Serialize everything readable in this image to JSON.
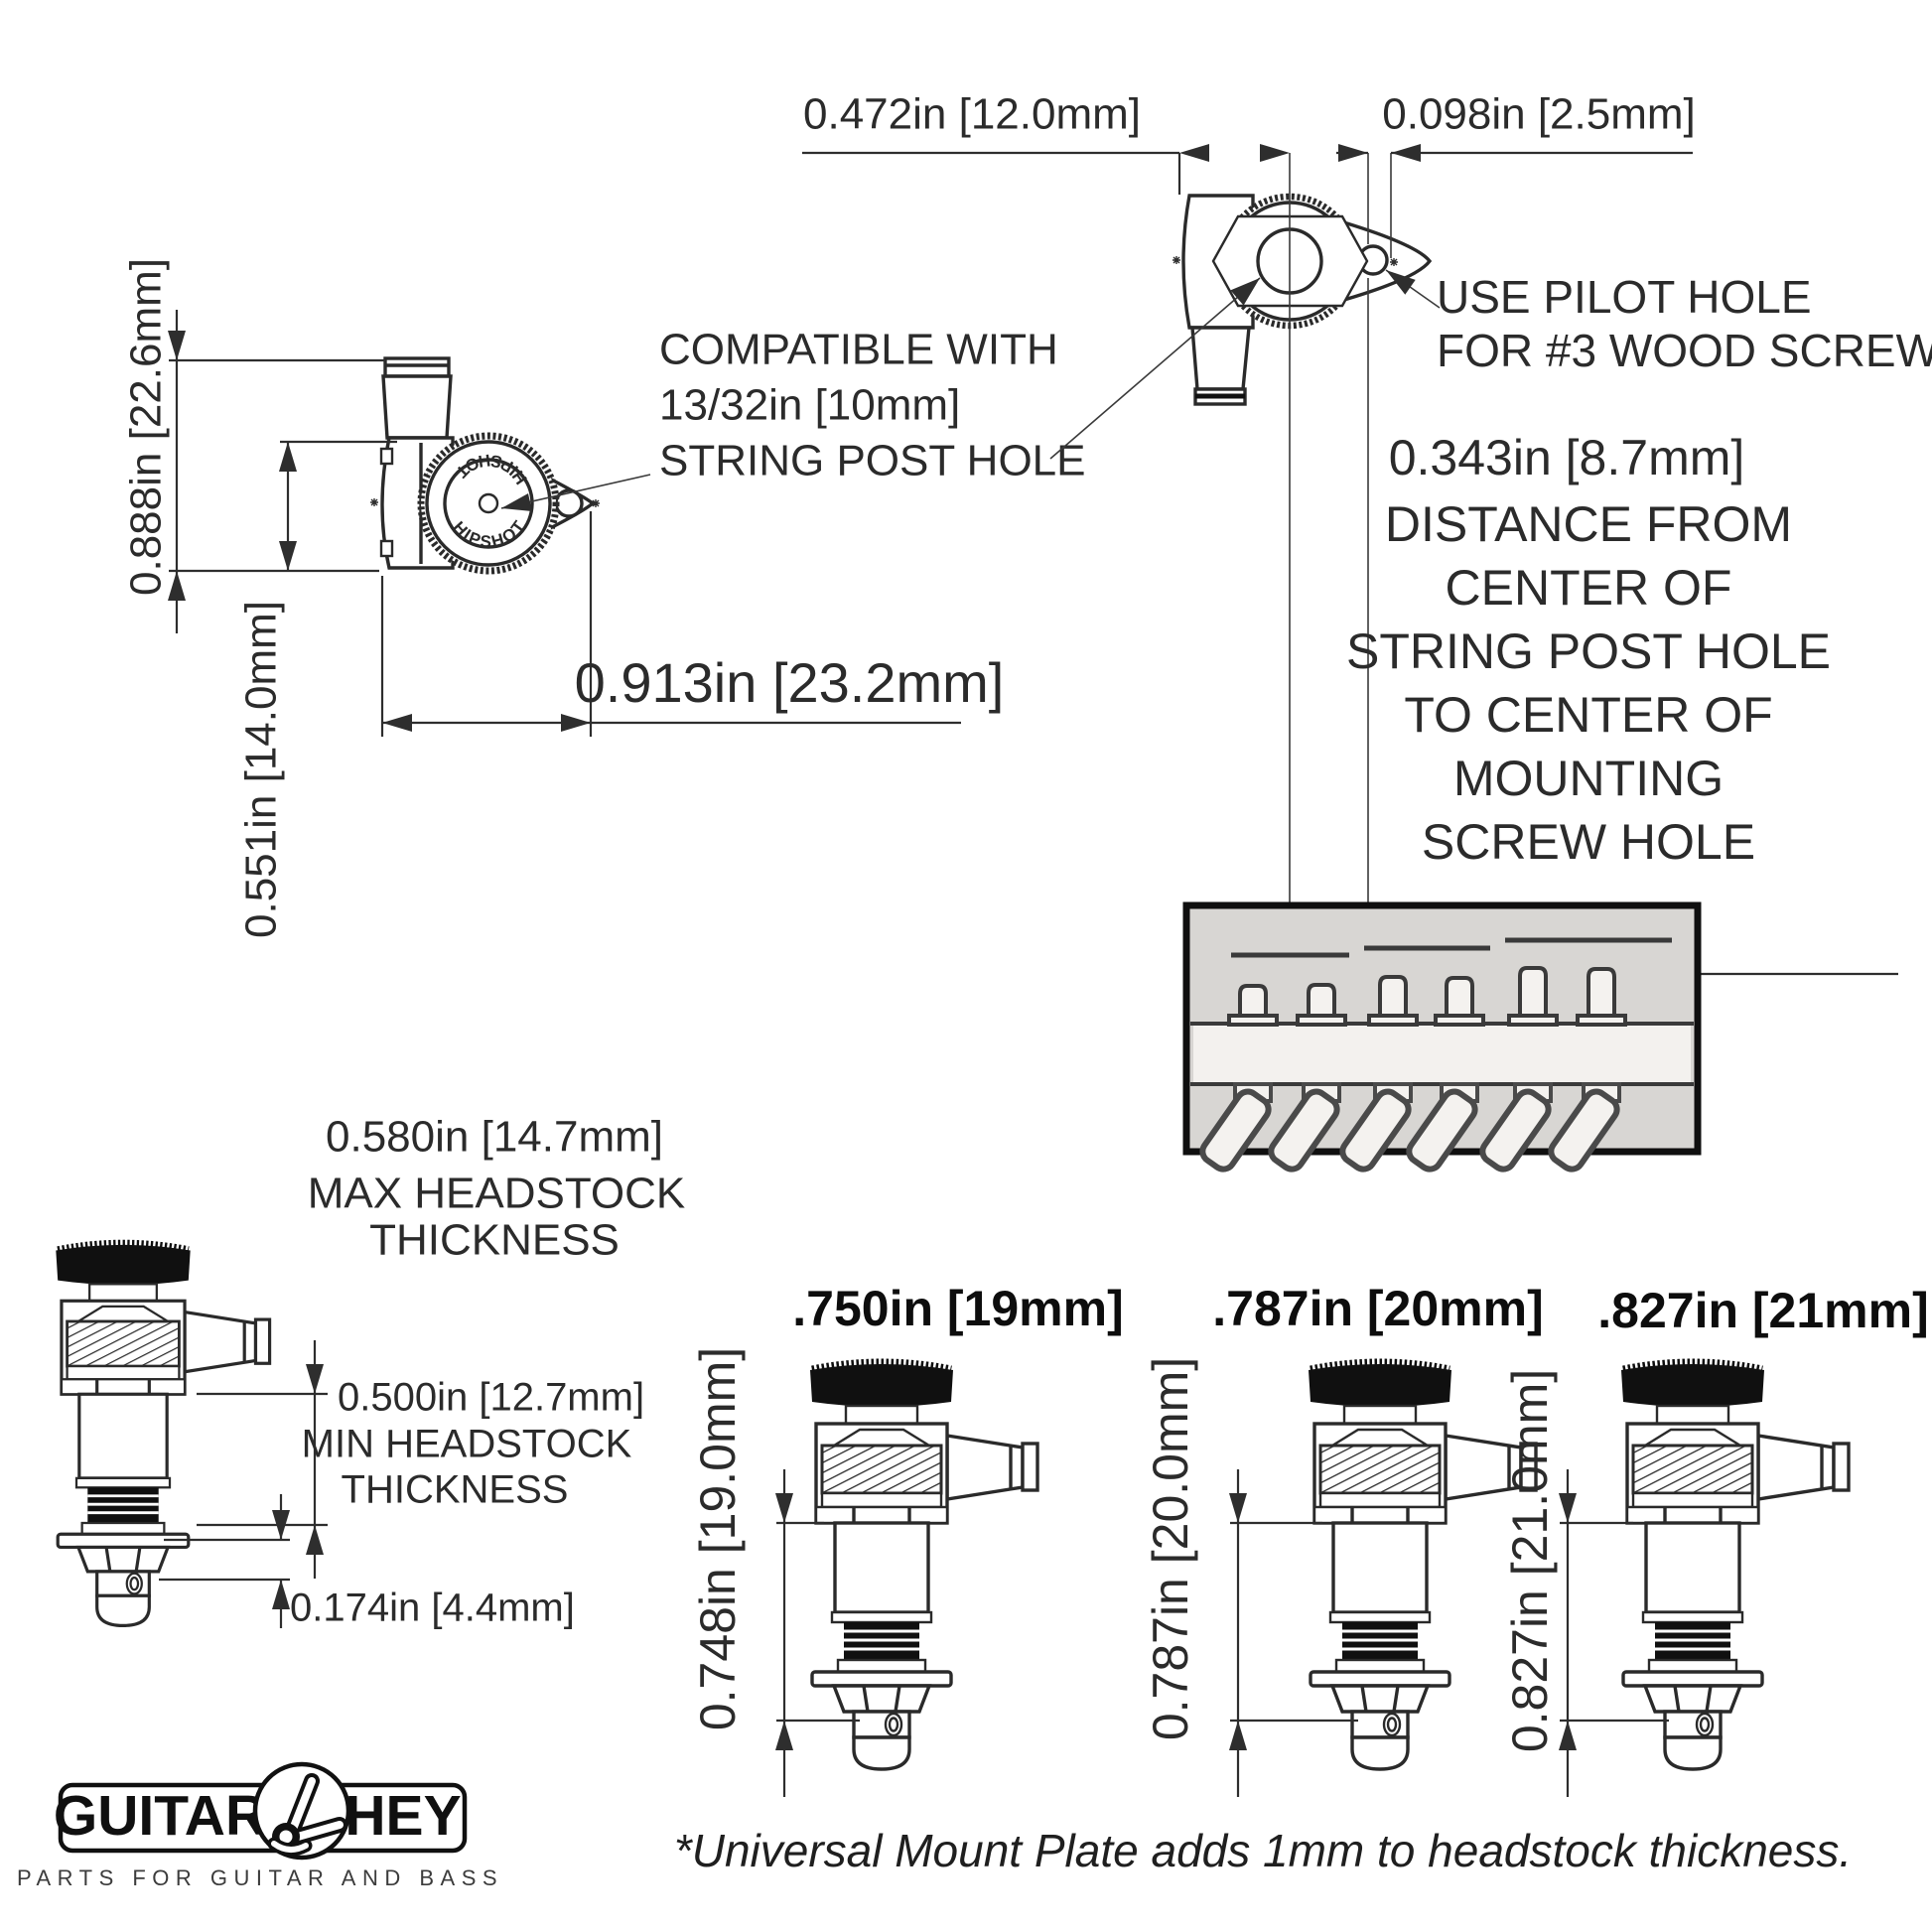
{
  "colors": {
    "ink": "#2b2b2b",
    "line": "#2e2e2e",
    "photo_bg": "#d8d6d3",
    "photo_band": "#f3f1ee"
  },
  "side_view": {
    "brand": "HIPSHOT",
    "dim_total_height": "0.888in [22.6mm]",
    "dim_base_height": "0.551in [14.0mm]",
    "dim_width": "0.913in [23.2mm]"
  },
  "top_view": {
    "dim_offset": "0.472in [12.0mm]",
    "dim_pilot": "0.098in [2.5mm]",
    "compat_lines": [
      "COMPATIBLE WITH",
      "13/32in [10mm]",
      "STRING POST HOLE"
    ],
    "pilot_lines": [
      "USE PILOT HOLE",
      "FOR #3 WOOD SCREW"
    ],
    "dist_dim": "0.343in [8.7mm]",
    "dist_lines": [
      "DISTANCE FROM",
      "CENTER OF",
      "STRING POST HOLE",
      "TO CENTER OF",
      "MOUNTING",
      "SCREW HOLE"
    ]
  },
  "thickness": {
    "max_dim": "0.580in [14.7mm]",
    "max_lines": [
      "MAX HEADSTOCK",
      "THICKNESS"
    ],
    "min_dim": "0.500in [12.7mm]",
    "min_lines": [
      "MIN HEADSTOCK",
      "THICKNESS"
    ],
    "post_dim": "0.174in [4.4mm]"
  },
  "post_options": [
    {
      "title": ".750in [19mm]",
      "dim": "0.748in [19.0mm]"
    },
    {
      "title": ".787in [20mm]",
      "dim": "0.787in [20.0mm]"
    },
    {
      "title": ".827in [21mm]",
      "dim": "0.827in [21.0mm]"
    }
  ],
  "footer": {
    "brand_left": "GUITAR",
    "brand_right": "HEY",
    "tagline": "PARTS FOR GUITAR AND BASS",
    "note": "*Universal Mount Plate adds 1mm to headstock thickness."
  }
}
